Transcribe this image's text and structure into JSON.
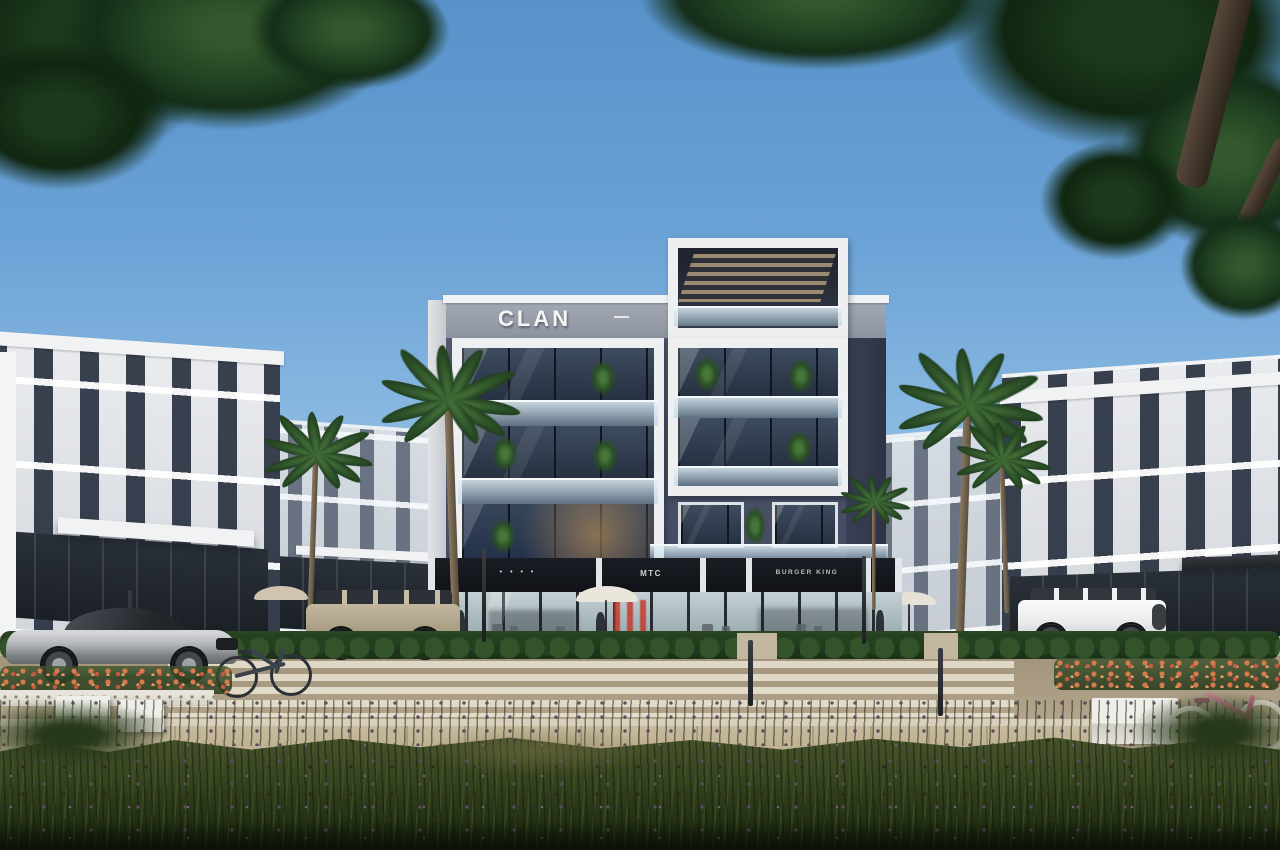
{
  "meta": {
    "title": "Architectural exterior render — CLAN mixed-use building",
    "scene_description": "Daytime architectural visualization: a four-storey dark-grey building with white frames and CLAN roof signage, ground-floor retail (MTC, BURGER KING), flanked by white residential blocks, palm trees, a street with zebra crosswalk, a silver sports car, a beige SUV, a white G-Class SUV, two bicycles, white benches, orange flower beds and a wildflower meadow in the foreground, framed by overhanging dark-green trees."
  },
  "signs": {
    "clan_logo": "CLAN",
    "storefronts": [
      {
        "id": "shop-dots",
        "label": "• • • •"
      },
      {
        "id": "shop-mtc",
        "label": "MTC"
      },
      {
        "id": "shop-burger-king",
        "label": "BURGER KING"
      }
    ]
  },
  "colors": {
    "sky_top": "#5792c9",
    "sky_horizon": "#c4dcee",
    "facade_dark": "#4a5066",
    "facade_light": "#e9ebee",
    "sign_band": "#14161c",
    "foliage": "#234523",
    "grass_dark": "#1f2c12",
    "road": "#a2947c",
    "flowers": "#d97a4c",
    "sports_car": "#aeb1b4",
    "suv_beige": "#b4a98f",
    "suv_white": "#f2f3f4",
    "bike_pink": "#c87f92"
  }
}
